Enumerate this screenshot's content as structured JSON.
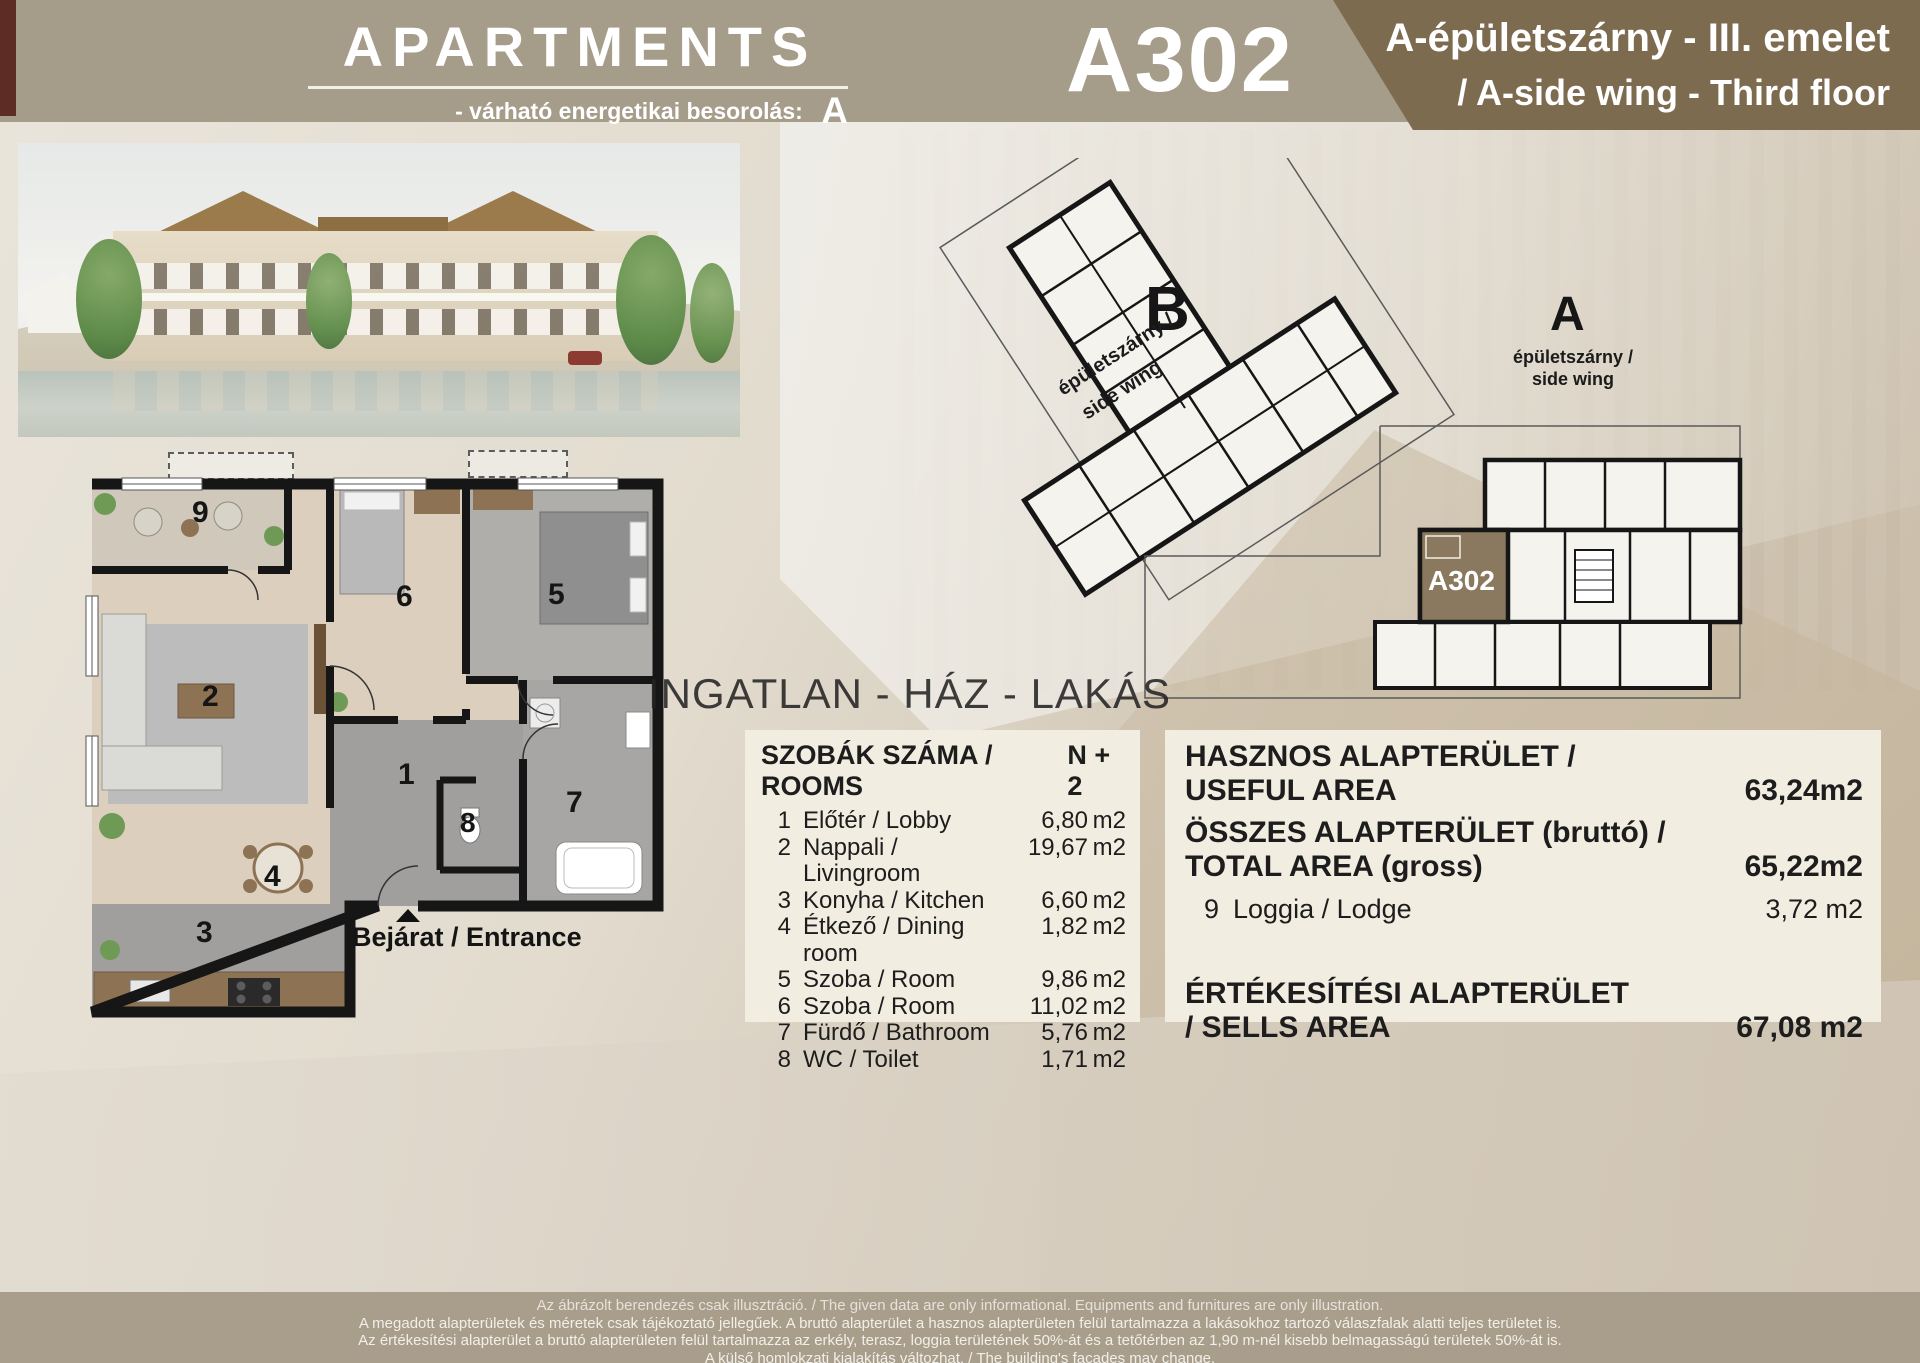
{
  "header": {
    "brand": "APARTMENTS",
    "energy_label": "-  várható energetikai besorolás:",
    "energy_class": "A",
    "unit_code": "A302",
    "wing_title_hu": "A-épületszárny - III. emelet",
    "wing_title_en": "/  A-side wing - Third floor"
  },
  "site_plan": {
    "wing_b": {
      "letter": "B",
      "label_line1": "épületszárny /",
      "label_line2": "side wing"
    },
    "wing_a": {
      "letter": "A",
      "label_line1": "épületszárny /",
      "label_line2": "side wing"
    },
    "highlighted_unit": "A302"
  },
  "compass": {
    "north": "É/N",
    "east": "K/E",
    "south": "D/S",
    "west": "Ny/W"
  },
  "watermark": "INGATLAN - HÁZ - LAKÁS",
  "floor_plan": {
    "entrance_label": "Bejárat / Entrance",
    "labels": {
      "lobby": "1",
      "living": "2",
      "kitchen": "3",
      "dining": "4",
      "room5": "5",
      "room6": "6",
      "bath": "7",
      "wc": "8",
      "loggia": "9"
    }
  },
  "rooms_table": {
    "title": "SZOBÁK SZÁMA / ROOMS",
    "count": "N + 2",
    "rows": [
      {
        "num": "1",
        "name": "Előtér / Lobby",
        "area": "6,80",
        "unit": "m2"
      },
      {
        "num": "2",
        "name": "Nappali / Livingroom",
        "area": "19,67",
        "unit": "m2"
      },
      {
        "num": "3",
        "name": "Konyha / Kitchen",
        "area": "6,60",
        "unit": "m2"
      },
      {
        "num": "4",
        "name": "Étkező / Dining room",
        "area": "1,82",
        "unit": "m2"
      },
      {
        "num": "5",
        "name": "Szoba / Room",
        "area": "9,86",
        "unit": "m2"
      },
      {
        "num": "6",
        "name": "Szoba / Room",
        "area": "11,02",
        "unit": "m2"
      },
      {
        "num": "7",
        "name": "Fürdő / Bathroom",
        "area": "5,76",
        "unit": "m2"
      },
      {
        "num": "8",
        "name": "WC / Toilet",
        "area": "1,71",
        "unit": "m2"
      }
    ]
  },
  "areas": {
    "useful_line1": "HASZNOS ALAPTERÜLET /",
    "useful_line2": "USEFUL AREA",
    "useful_value": "63,24m2",
    "gross_line1": "ÖSSZES ALAPTERÜLET (bruttó) /",
    "gross_line2": "TOTAL AREA (gross)",
    "gross_value": "65,22m2",
    "loggia_num": "9",
    "loggia_name": "Loggia / Lodge",
    "loggia_value": "3,72  m2",
    "sells_line1": "ÉRTÉKESÍTÉSI ALAPTERÜLET",
    "sells_line2": "/ SELLS AREA",
    "sells_value": "67,08 m2"
  },
  "footer": {
    "lines": [
      "Az ábrázolt berendezés csak illusztráció.  /  The given data are only informational. Equipments and furnitures are only illustration.",
      "A megadott alapterületek és méretek csak tájékoztató jellegűek. A bruttó alapterület a hasznos alapterületen felül tartalmazza a lakásokhoz tartozó válaszfalak alatti teljes területet is.",
      "Az értékesítési alapterület a bruttó alapterületen felül tartalmazza az erkély, terasz, loggia területének 50%-át és a tetőtérben az 1,90 m-nél kisebb belmagasságú területek 50%-át is.",
      "A külső homlokzati kialakítás változhat. / The building's facades may change."
    ]
  },
  "colors": {
    "header_band": "#a69c8a",
    "header_panel_brown": "#7d6b4f",
    "info_panel_cream": "#f2ede1",
    "footer_band": "#a99e8c",
    "unit_highlight_brown": "#8a795e"
  }
}
